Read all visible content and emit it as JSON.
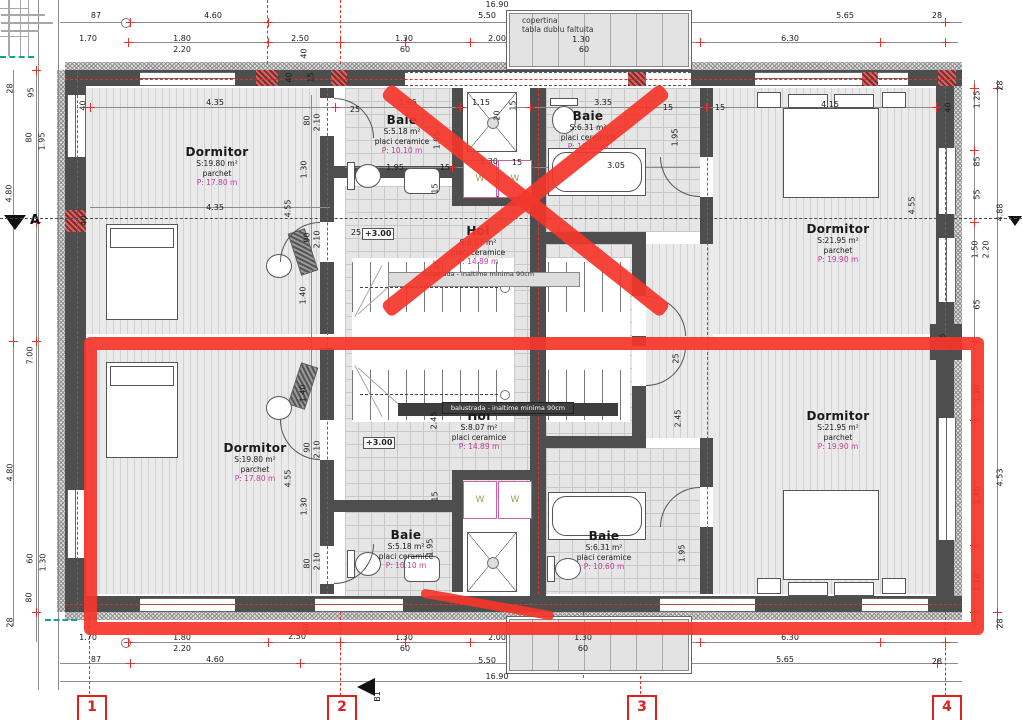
{
  "canopy": {
    "line1": "copertina",
    "line2": "tabla dublu faltuita"
  },
  "washer_label": "W",
  "axis": {
    "a": "A",
    "b1": "B1"
  },
  "grid_markers": [
    {
      "label": "1",
      "x": 90
    },
    {
      "label": "2",
      "x": 340
    },
    {
      "label": "3",
      "x": 640
    },
    {
      "label": "4",
      "x": 945
    }
  ],
  "level_markers": [
    {
      "label": "+3.00",
      "x": 362,
      "y": 228
    },
    {
      "label": "+3.00",
      "x": 363,
      "y": 437
    }
  ],
  "notes": [
    {
      "text": "bal.strada - inaltime minima 90cm",
      "x": 478,
      "y": 270,
      "style": "light"
    },
    {
      "text": "balustrada - inaltime minima 90cm",
      "x": 508,
      "y": 402,
      "style": "dark"
    }
  ],
  "rooms": [
    {
      "name": "Dormitor",
      "area": "S:19.80 m²",
      "finish": "parchet",
      "perimeter": "P: 17.80 m",
      "x": 217,
      "y": 153
    },
    {
      "name": "Baie",
      "area": "S:5.18 m²",
      "finish": "placi ceramice",
      "perimeter": "P: 10.10 m",
      "x": 402,
      "y": 121
    },
    {
      "name": "Baie",
      "area": "S:6.31 m²",
      "finish": "placi ceramice",
      "perimeter": "P: 10.60 m",
      "x": 588,
      "y": 117
    },
    {
      "name": "Hol",
      "area": "S:8.07 m²",
      "finish": "placi ceramice",
      "perimeter": "P: 14.89 m",
      "x": 478,
      "y": 232
    },
    {
      "name": "Dormitor",
      "area": "S:21.95 m²",
      "finish": "parchet",
      "perimeter": "P: 19.90 m",
      "x": 838,
      "y": 230
    },
    {
      "name": "Dormitor",
      "area": "S:19.80 m²",
      "finish": "parchet",
      "perimeter": "P: 17.80 m",
      "x": 255,
      "y": 449
    },
    {
      "name": "Hol",
      "area": "S:8.07 m²",
      "finish": "placi ceramice",
      "perimeter": "P: 14.89 m",
      "x": 479,
      "y": 417
    },
    {
      "name": "Baie",
      "area": "S:5.18 m²",
      "finish": "placi ceramice",
      "perimeter": "P: 10.10 m",
      "x": 406,
      "y": 536
    },
    {
      "name": "Baie",
      "area": "S:6.31 m²",
      "finish": "placi ceramice",
      "perimeter": "P: 10.60 m",
      "x": 604,
      "y": 537
    },
    {
      "name": "Dormitor",
      "area": "S:21.95 m²",
      "finish": "parchet",
      "perimeter": "P: 19.90 m",
      "x": 838,
      "y": 417
    }
  ],
  "dims": [
    [
      "16.90",
      497,
      4
    ],
    [
      "87",
      96,
      15
    ],
    [
      "4.60",
      213,
      15
    ],
    [
      "5.50",
      487,
      15
    ],
    [
      "5.65",
      845,
      15
    ],
    [
      "28",
      937,
      15
    ],
    [
      "1.70",
      88,
      38
    ],
    [
      "1.80",
      182,
      38
    ],
    [
      "2.50",
      300,
      38
    ],
    [
      "1.30",
      404,
      38
    ],
    [
      "2.00",
      497,
      38
    ],
    [
      "1.30",
      581,
      39
    ],
    [
      "6.30",
      790,
      38
    ],
    [
      "2.20",
      182,
      49
    ],
    [
      "60",
      405,
      49
    ],
    [
      "60",
      584,
      49
    ],
    [
      "4.35",
      215,
      102
    ],
    [
      "25",
      355,
      109
    ],
    [
      "1.95",
      408,
      102
    ],
    [
      "1.15",
      481,
      102
    ],
    [
      "15",
      513,
      105,
      1
    ],
    [
      "3.35",
      603,
      102
    ],
    [
      "15",
      668,
      107
    ],
    [
      "15",
      720,
      107
    ],
    [
      "4.15",
      830,
      104
    ],
    [
      "40",
      83,
      105,
      1
    ],
    [
      "40",
      948,
      107,
      1
    ],
    [
      "40",
      304,
      53,
      1
    ],
    [
      "40",
      289,
      77,
      1
    ],
    [
      "15",
      311,
      77,
      1
    ],
    [
      "20",
      497,
      115,
      1
    ],
    [
      "80",
      307,
      120,
      1
    ],
    [
      "2.10",
      317,
      122,
      1
    ],
    [
      "1.30",
      304,
      169,
      1
    ],
    [
      "4.55",
      288,
      208,
      1
    ],
    [
      "90",
      307,
      237,
      1
    ],
    [
      "2.10",
      317,
      239,
      1
    ],
    [
      "25",
      356,
      232
    ],
    [
      "4.35",
      215,
      207
    ],
    [
      "40",
      84,
      220,
      1
    ],
    [
      "1.95",
      395,
      167
    ],
    [
      "15",
      445,
      167
    ],
    [
      "1.30",
      489,
      161
    ],
    [
      "15",
      517,
      162
    ],
    [
      "3.05",
      616,
      165
    ],
    [
      "1.95",
      675,
      137,
      1
    ],
    [
      "1.95",
      437,
      140,
      1
    ],
    [
      "2.45",
      437,
      268,
      1
    ],
    [
      "4.55",
      912,
      205,
      1
    ],
    [
      "15",
      435,
      188,
      1
    ],
    [
      "2.45",
      434,
      420,
      1
    ],
    [
      "2.45",
      678,
      418,
      1
    ],
    [
      "25",
      676,
      358,
      1
    ],
    [
      "1.40",
      303,
      295,
      1
    ],
    [
      "1.40",
      303,
      393,
      1
    ],
    [
      "90",
      307,
      447,
      1
    ],
    [
      "2.10",
      317,
      449,
      1
    ],
    [
      "4.55",
      288,
      478,
      1
    ],
    [
      "1.30",
      304,
      506,
      1
    ],
    [
      "80",
      307,
      563,
      1
    ],
    [
      "2.10",
      317,
      561,
      1
    ],
    [
      "1.95",
      430,
      547,
      1
    ],
    [
      "1.95",
      682,
      553,
      1
    ],
    [
      "15",
      435,
      496,
      1
    ],
    [
      "1.70",
      88,
      637
    ],
    [
      "1.80",
      182,
      637
    ],
    [
      "2.20",
      182,
      648
    ],
    [
      "2.50",
      297,
      636
    ],
    [
      "40",
      306,
      628,
      1
    ],
    [
      "1.30",
      404,
      637
    ],
    [
      "60",
      405,
      648
    ],
    [
      "2.00",
      497,
      637
    ],
    [
      "1.30",
      583,
      637
    ],
    [
      "60",
      583,
      648
    ],
    [
      "6.30",
      790,
      637
    ],
    [
      "87",
      96,
      659
    ],
    [
      "4.60",
      215,
      659
    ],
    [
      "5.50",
      487,
      660
    ],
    [
      "5.65",
      785,
      659
    ],
    [
      "28",
      937,
      661
    ],
    [
      "16.90",
      497,
      676
    ],
    [
      "28",
      10,
      88,
      1
    ],
    [
      "95",
      31,
      92,
      1
    ],
    [
      "80",
      29,
      137,
      1
    ],
    [
      "1.95",
      42,
      141,
      1
    ],
    [
      "4.80",
      9,
      193,
      1
    ],
    [
      "7.00",
      30,
      355,
      1
    ],
    [
      "4.80",
      10,
      472,
      1
    ],
    [
      "60",
      30,
      558,
      1
    ],
    [
      "1.30",
      43,
      562,
      1
    ],
    [
      "80",
      29,
      597,
      1
    ],
    [
      "28",
      10,
      622,
      1
    ],
    [
      "28",
      1000,
      85,
      1
    ],
    [
      "1.25",
      977,
      99,
      1
    ],
    [
      "85",
      977,
      161,
      1
    ],
    [
      "55",
      977,
      194,
      1
    ],
    [
      "4.88",
      1000,
      212,
      1
    ],
    [
      "1.50",
      975,
      249,
      1
    ],
    [
      "2.20",
      986,
      249,
      1
    ],
    [
      "65",
      977,
      304,
      1
    ],
    [
      "55",
      943,
      338,
      1
    ],
    [
      "40",
      951,
      343,
      1
    ],
    [
      "1.30",
      977,
      393,
      1
    ],
    [
      "4.53",
      1000,
      477,
      1
    ],
    [
      "2.40",
      977,
      495,
      1
    ],
    [
      "1.10",
      977,
      582,
      1
    ],
    [
      "28",
      1000,
      623,
      1
    ]
  ],
  "colors": {
    "annotation_red": "#f4372c",
    "dimension_red": "#e03228",
    "wall_gray": "#4e4e4e",
    "perimeter_magenta": "#c73a9d"
  }
}
